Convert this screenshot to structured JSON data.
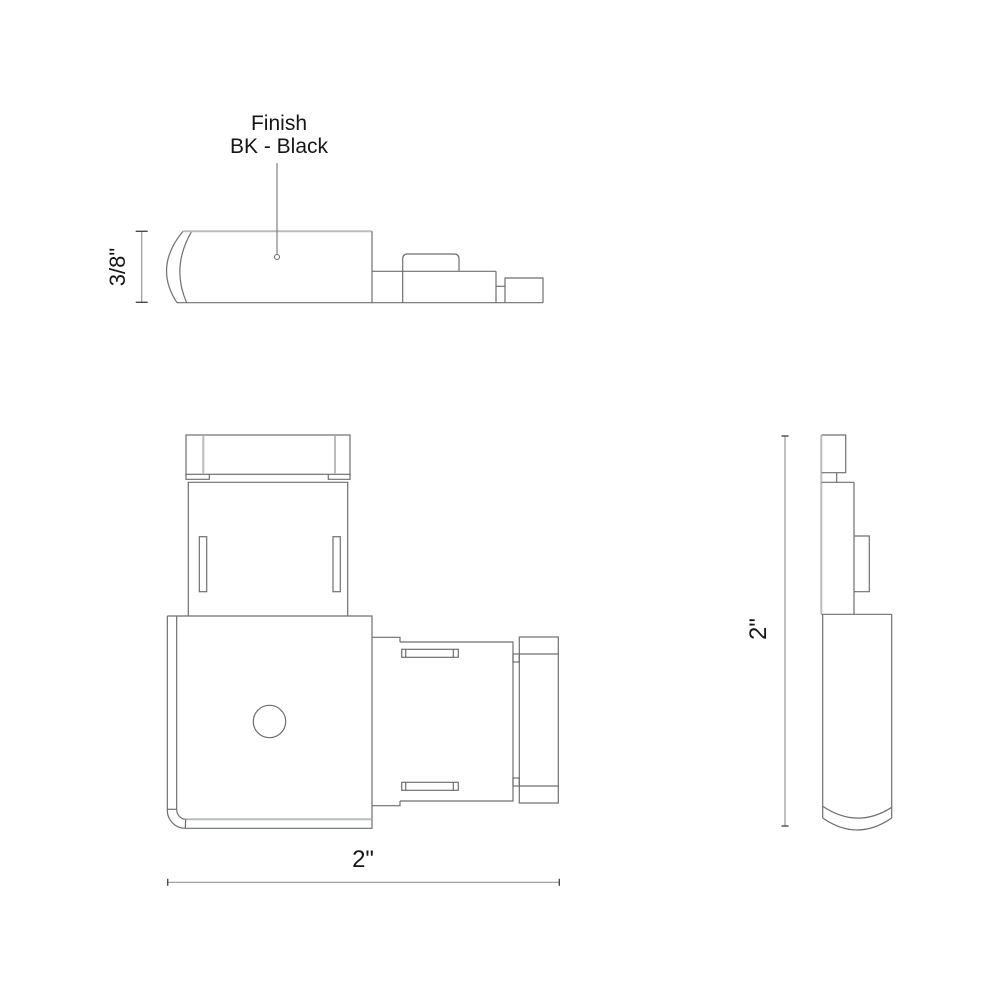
{
  "callout": {
    "title": "Finish",
    "value": "BK - Black"
  },
  "dimensions": {
    "profile_height": "3/8\"",
    "plan_width": "2\"",
    "side_height": "2\""
  },
  "colors": {
    "outline": "#6f6f6f",
    "light_outline": "#b9bdbf",
    "dimension_line": "#989898",
    "tick": "#4a4a4a",
    "leader": "#6a6a6a",
    "text": "#161616",
    "background": "#ffffff"
  }
}
